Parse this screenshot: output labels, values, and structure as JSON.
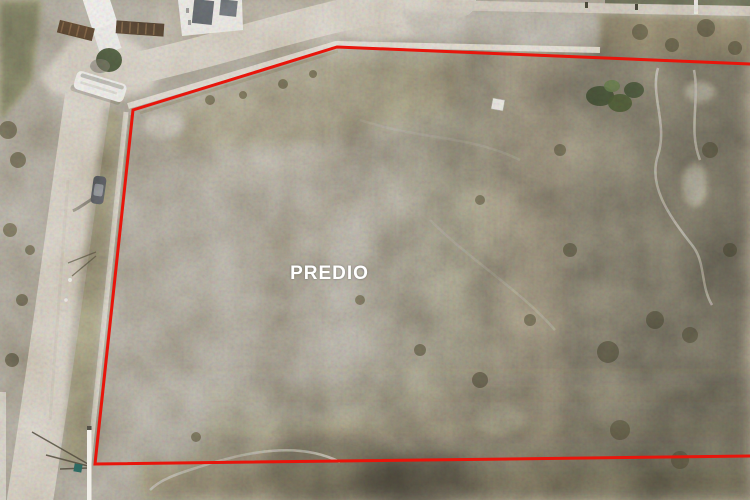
{
  "scene": {
    "type": "aerial-drone-photograph",
    "subject": "vacant land parcel (predio) outlined in red",
    "label": {
      "text": "PREDIO",
      "color": "#ffffff"
    },
    "boundary": {
      "color": "#e8150b",
      "stroke_width": "3",
      "points": "750,64 337,47 133,110 95,464 750,456"
    }
  }
}
